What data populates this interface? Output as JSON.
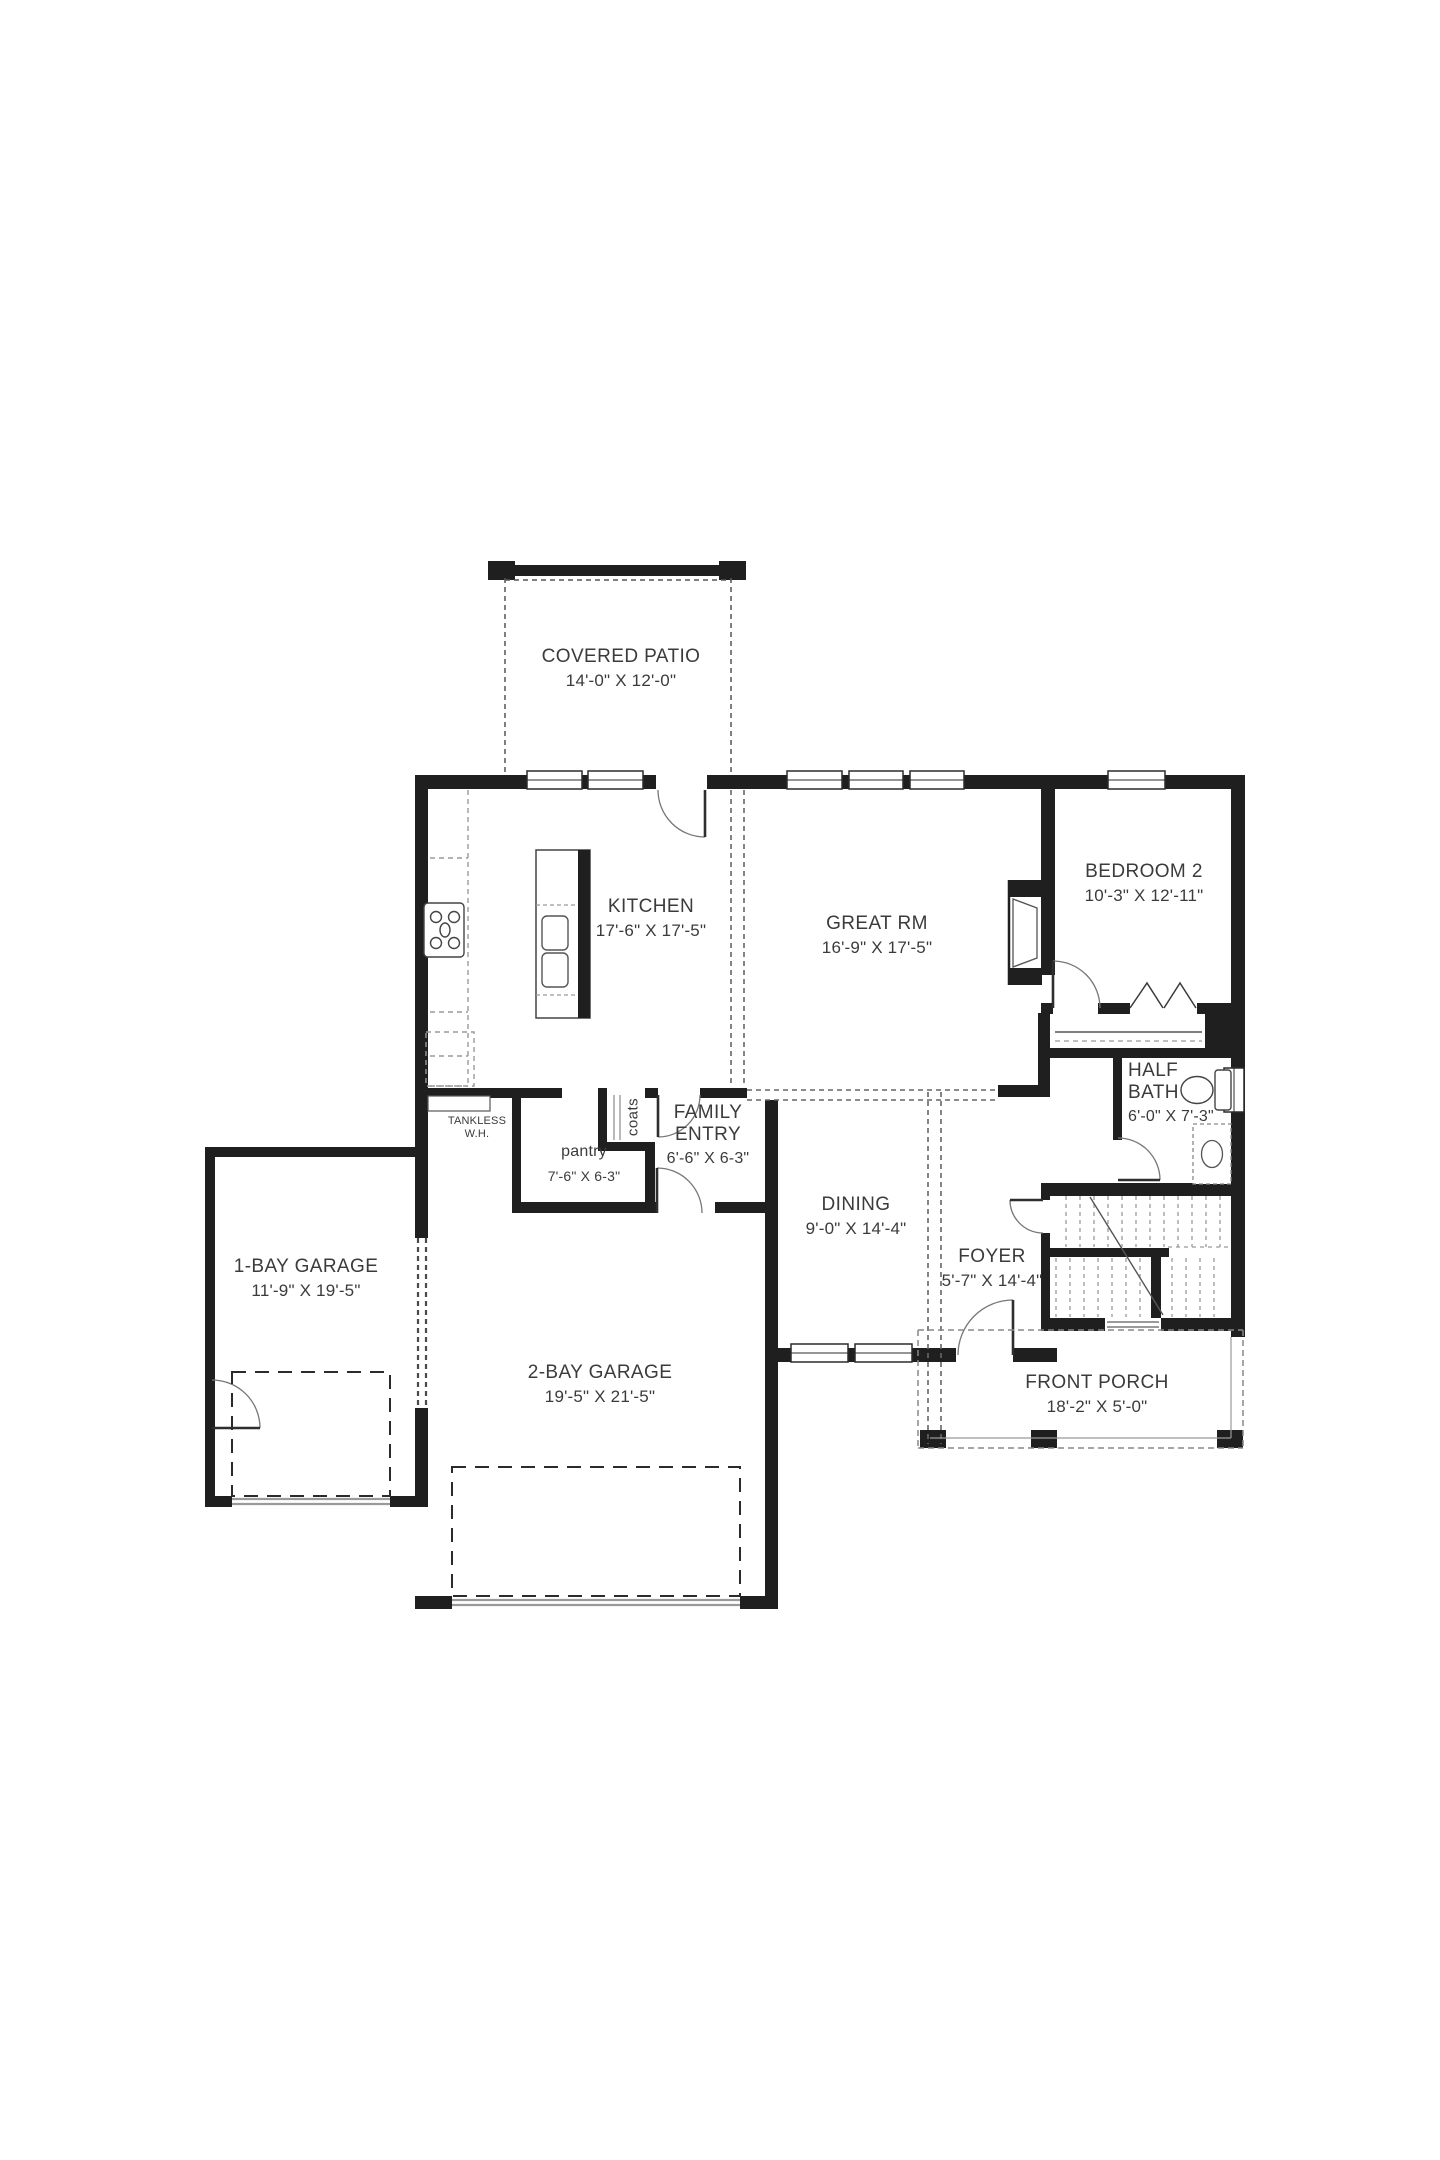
{
  "plan": {
    "rooms": [
      {
        "id": "covered-patio",
        "name": "COVERED PATIO",
        "dims": "14'-0\" X 12'-0\""
      },
      {
        "id": "kitchen",
        "name": "KITCHEN",
        "dims": "17'-6\" X 17'-5\""
      },
      {
        "id": "great-rm",
        "name": "GREAT RM",
        "dims": "16'-9\" X 17'-5\""
      },
      {
        "id": "bedroom-2",
        "name": "BEDROOM 2",
        "dims": "10'-3\" X 12'-11\""
      },
      {
        "id": "half-bath",
        "name": "HALF",
        "name2": "BATH",
        "dims": "6'-0\" X 7'-3\""
      },
      {
        "id": "family-entry",
        "name": "FAMILY",
        "name2": "ENTRY",
        "dims": "6'-6\" X 6-3\""
      },
      {
        "id": "pantry",
        "name": "pantry",
        "dims": "7'-6\" X 6-3\""
      },
      {
        "id": "dining",
        "name": "DINING",
        "dims": "9'-0\" X 14'-4\""
      },
      {
        "id": "foyer",
        "name": "FOYER",
        "dims": "5'-7\" X 14'-4\""
      },
      {
        "id": "garage-1-bay",
        "name": "1-BAY GARAGE",
        "dims": "11'-9\" X 19'-5\""
      },
      {
        "id": "garage-2-bay",
        "name": "2-BAY GARAGE",
        "dims": "19'-5\" X 21'-5\""
      },
      {
        "id": "front-porch",
        "name": "FRONT PORCH",
        "dims": "18'-2\" X 5'-0\""
      }
    ],
    "annotations": {
      "tankless_line1": "TANKLESS",
      "tankless_line2": "W.H.",
      "coats": "coats"
    },
    "colors": {
      "wall": "#1f1f1f",
      "text": "#3b3b3b",
      "dashed": "#555555",
      "light_dash": "#9a9a9a"
    }
  }
}
